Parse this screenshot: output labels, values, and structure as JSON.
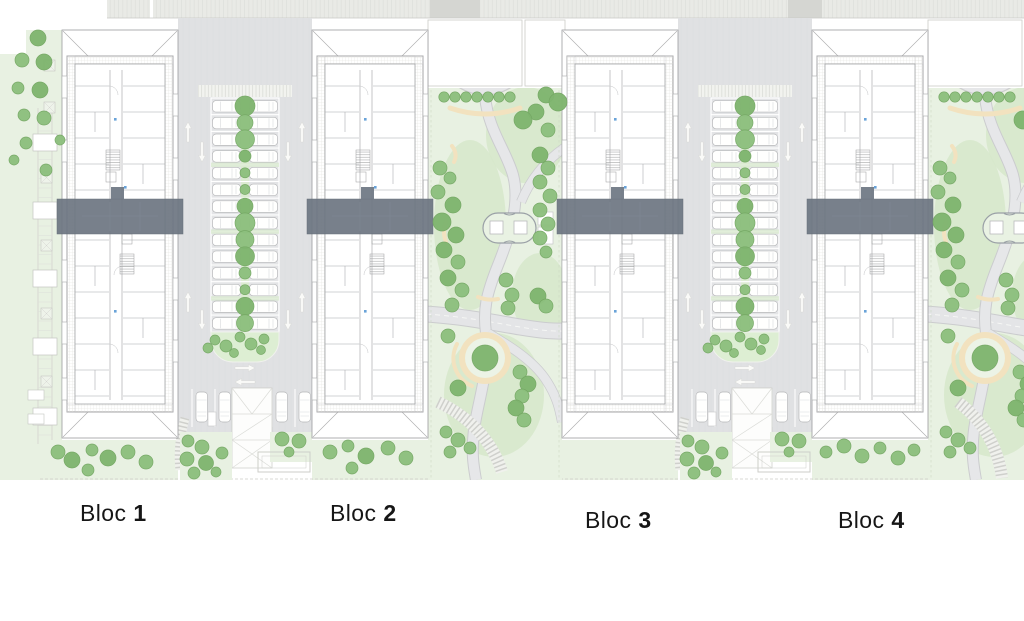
{
  "plan": {
    "blocks": [
      {
        "word": "Bloc",
        "number": "1"
      },
      {
        "word": "Bloc",
        "number": "2"
      },
      {
        "word": "Bloc",
        "number": "3"
      },
      {
        "word": "Bloc",
        "number": "4"
      }
    ],
    "colors": {
      "background": "#ffffff",
      "tree": "#8dc07e",
      "tree_dark": "#7fb56f",
      "park_light": "#e8f1e2",
      "park_shade": "#d6e8ca",
      "asphalt": "#e0e1e3",
      "path_fill": "#e6e7e9",
      "path_edge": "#cbccce",
      "sand": "#f2e2bf",
      "sidewalk": "#e9eae6",
      "overlay": "#6d7682",
      "label_text": "#161616"
    }
  }
}
